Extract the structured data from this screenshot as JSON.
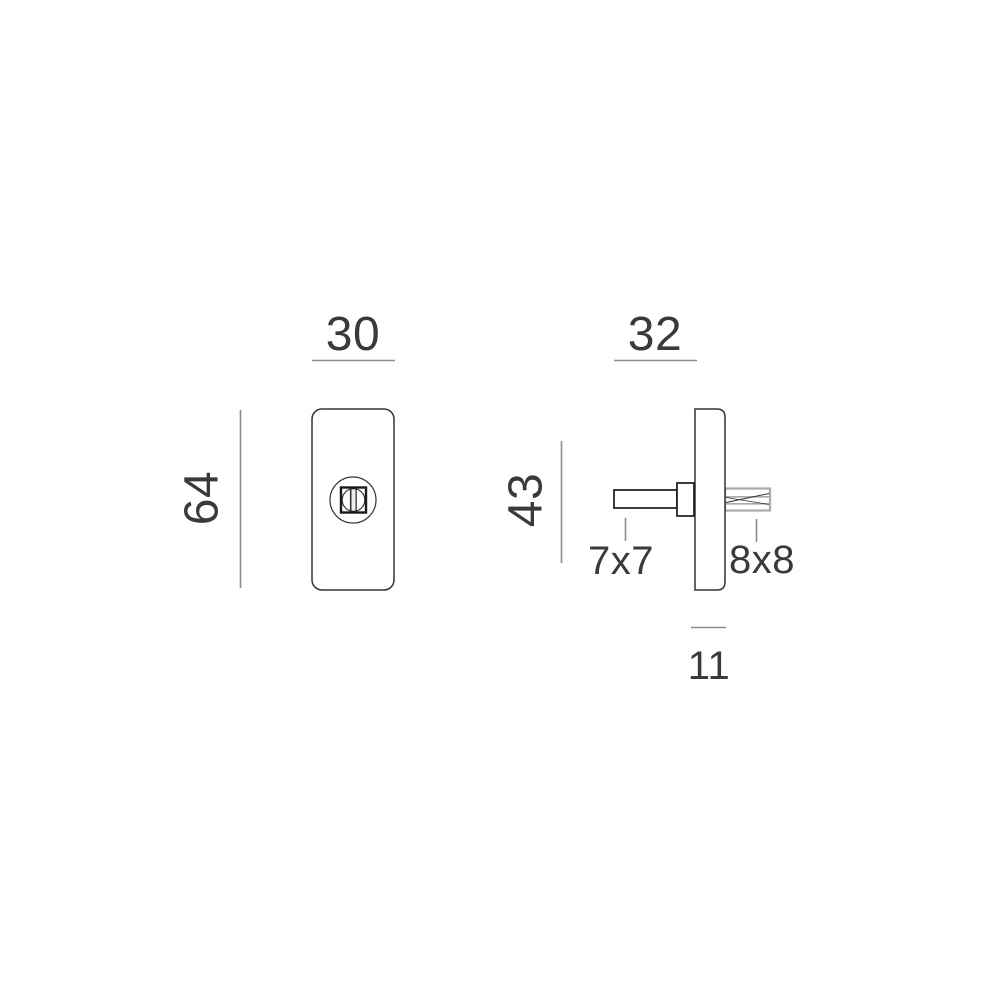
{
  "drawing": {
    "type": "technical-dimension-drawing",
    "subject": "escutcheon-plate-with-spindle",
    "colors": {
      "background": "#ffffff",
      "outline": "#333333",
      "outline_strong": "#1a1a1a",
      "outline_light": "#ababab",
      "dimension_line": "#8c8c8c",
      "text": "#3a3a3a",
      "slot_fill": "#ececec"
    },
    "front_view": {
      "width_dim": "30",
      "height_dim": "64"
    },
    "side_view": {
      "width_dim": "32",
      "height_dim": "43",
      "left_spindle_dim": "7x7",
      "right_spindle_dim": "8x8",
      "thickness_dim": "11"
    }
  }
}
